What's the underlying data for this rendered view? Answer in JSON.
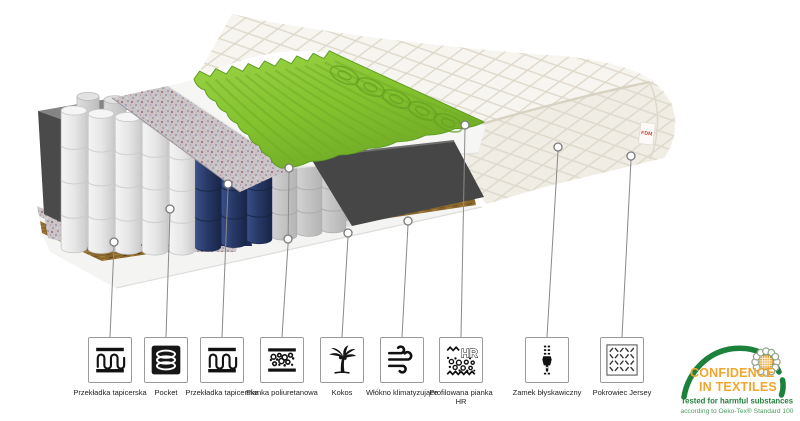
{
  "illustration": {
    "brand_tag": "FDM",
    "description": "mattress cross-section cutaway"
  },
  "legend": {
    "items": [
      {
        "icon": "upholstery-insert-icon",
        "label": "Przekładka tapicerska"
      },
      {
        "icon": "pocket-spring-icon",
        "label": "Pocket"
      },
      {
        "icon": "upholstery-insert-icon",
        "label": "Przekładka tapicerska"
      },
      {
        "icon": "polyurethane-foam-icon",
        "label": "Pianka poliuretanowa"
      },
      {
        "icon": "coconut-icon",
        "label": "Kokos"
      },
      {
        "icon": "climate-fiber-icon",
        "label": "Włókno klimatyzujące"
      },
      {
        "icon": "profiled-hr-foam-icon",
        "label": "Profilowana pianka HR"
      },
      {
        "icon": "zipper-icon",
        "label": "Zamek błyskawiczny"
      },
      {
        "icon": "jersey-cover-icon",
        "label": "Pokrowiec Jersey"
      }
    ]
  },
  "certification": {
    "title_line1": "CONFIDENCE",
    "title_line2": "IN TEXTILES",
    "subtitle": "Tested for harmful substances",
    "note": "according to Oeko-Tex® Standard 100"
  },
  "colors": {
    "green_foam": "#84c22e",
    "green_foam_dark": "#6dac26",
    "green_foam_edge": "#5f9e22",
    "navy_fabric": "#253a6f",
    "navy_fabric_dark": "#17254a",
    "coconut_brown": "#8a672c",
    "cover_cream": "#f7f5ef",
    "cert_green": "#1c813b",
    "cert_orange": "#f2a62f",
    "brand_red": "#c8382e"
  }
}
